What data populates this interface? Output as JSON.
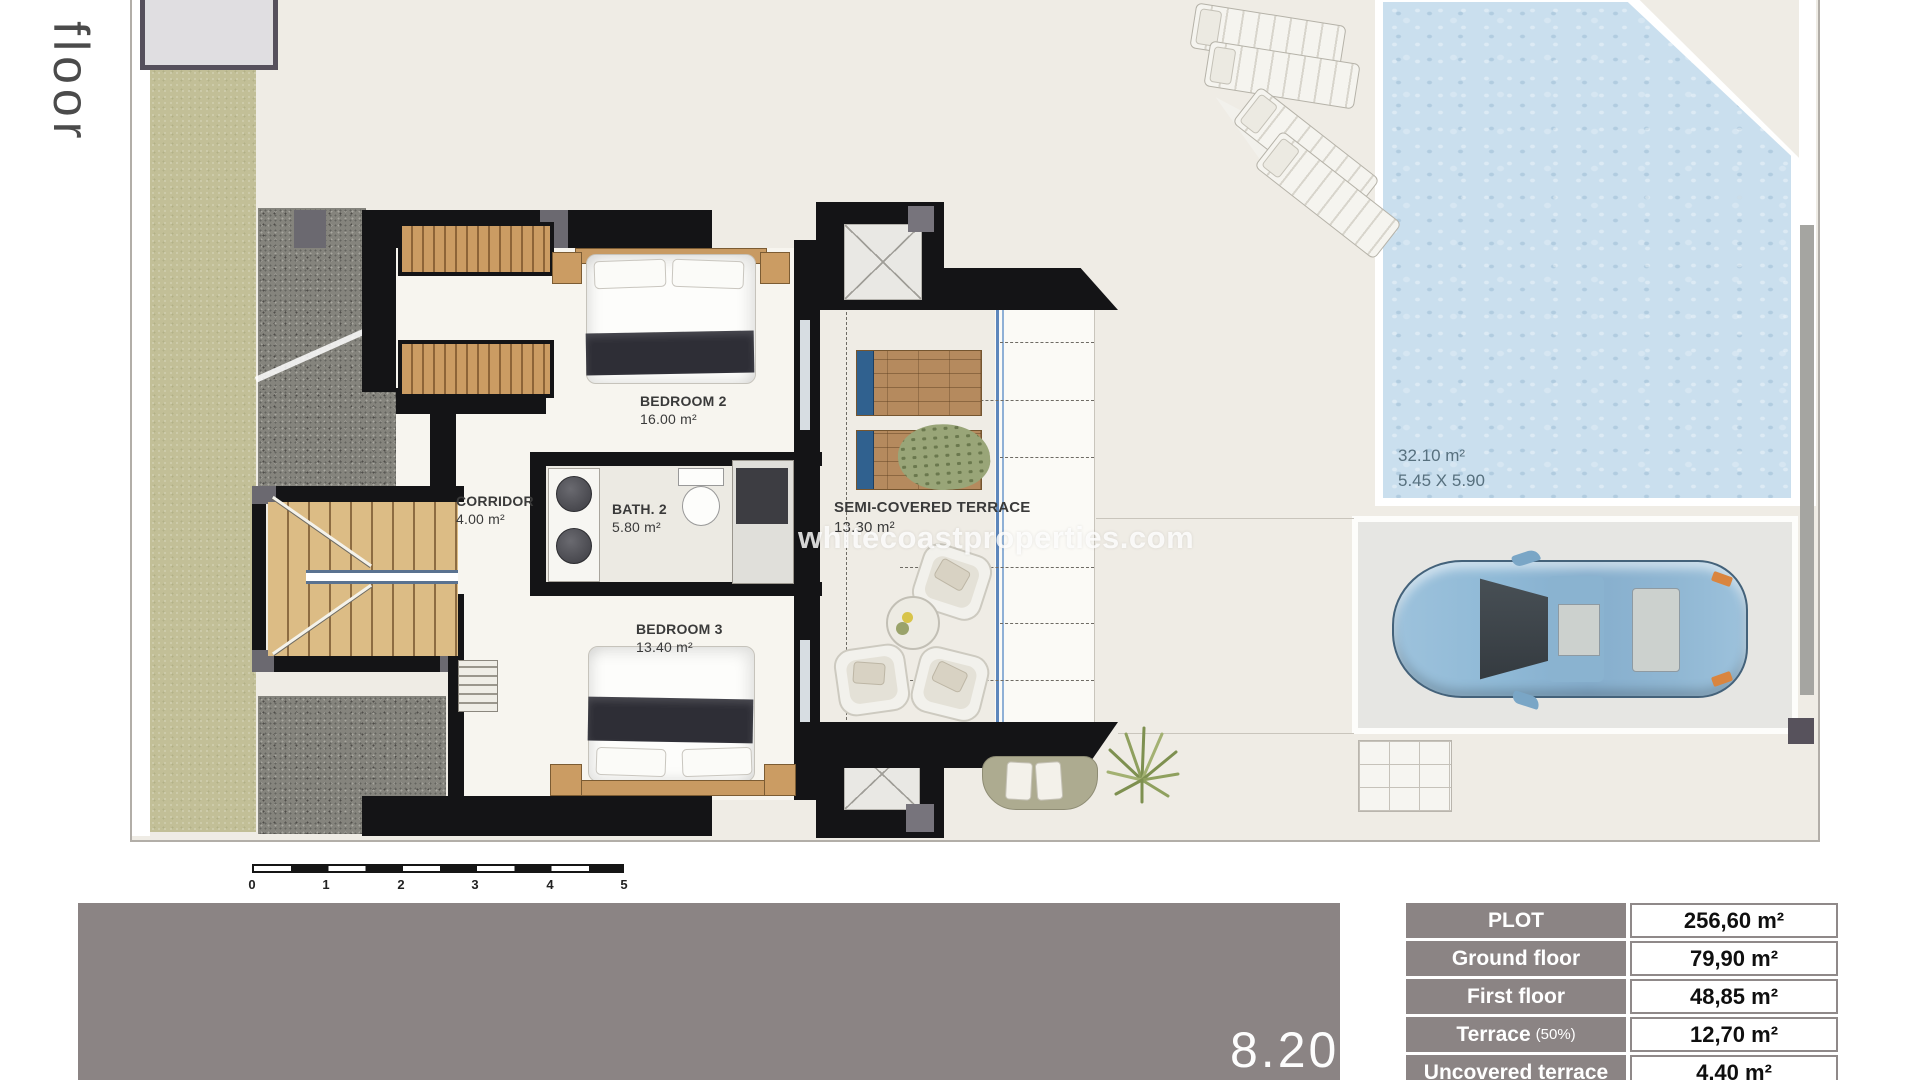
{
  "page": {
    "floor_label": "First floor",
    "watermark": "whitecoastproperties.com",
    "plan_number": "8.20"
  },
  "rooms": {
    "bedroom2": {
      "name": "BEDROOM 2",
      "area": "16.00 m²"
    },
    "corridor": {
      "name": "CORRIDOR",
      "area": "4.00 m²"
    },
    "bath2": {
      "name": "BATH. 2",
      "area": "5.80 m²"
    },
    "bedroom3": {
      "name": "BEDROOM 3",
      "area": "13.40 m²"
    },
    "terrace": {
      "name": "SEMI-COVERED TERRACE",
      "area": "13.30 m²"
    }
  },
  "pool": {
    "area": "32.10 m²",
    "dimensions": "5.45 X 5.90"
  },
  "scale_bar": {
    "ticks": [
      "0",
      "1",
      "2",
      "3",
      "4",
      "5"
    ]
  },
  "areas_table": {
    "rows": [
      {
        "label": "PLOT",
        "note": "",
        "value": "256,60 m²"
      },
      {
        "label": "Ground floor",
        "note": "",
        "value": "79,90 m²"
      },
      {
        "label": "First floor",
        "note": "",
        "value": "48,85 m²"
      },
      {
        "label": "Terrace",
        "note": "(50%)",
        "value": "12,70 m²"
      },
      {
        "label": "Uncovered terrace",
        "note": "",
        "value": "4,40 m²"
      }
    ]
  },
  "colors": {
    "accent_gray": "#8b8484",
    "wall": "#141416",
    "pool_water": "#cadfee",
    "wood": "#cb9c63",
    "olive": "#c2bf97"
  }
}
